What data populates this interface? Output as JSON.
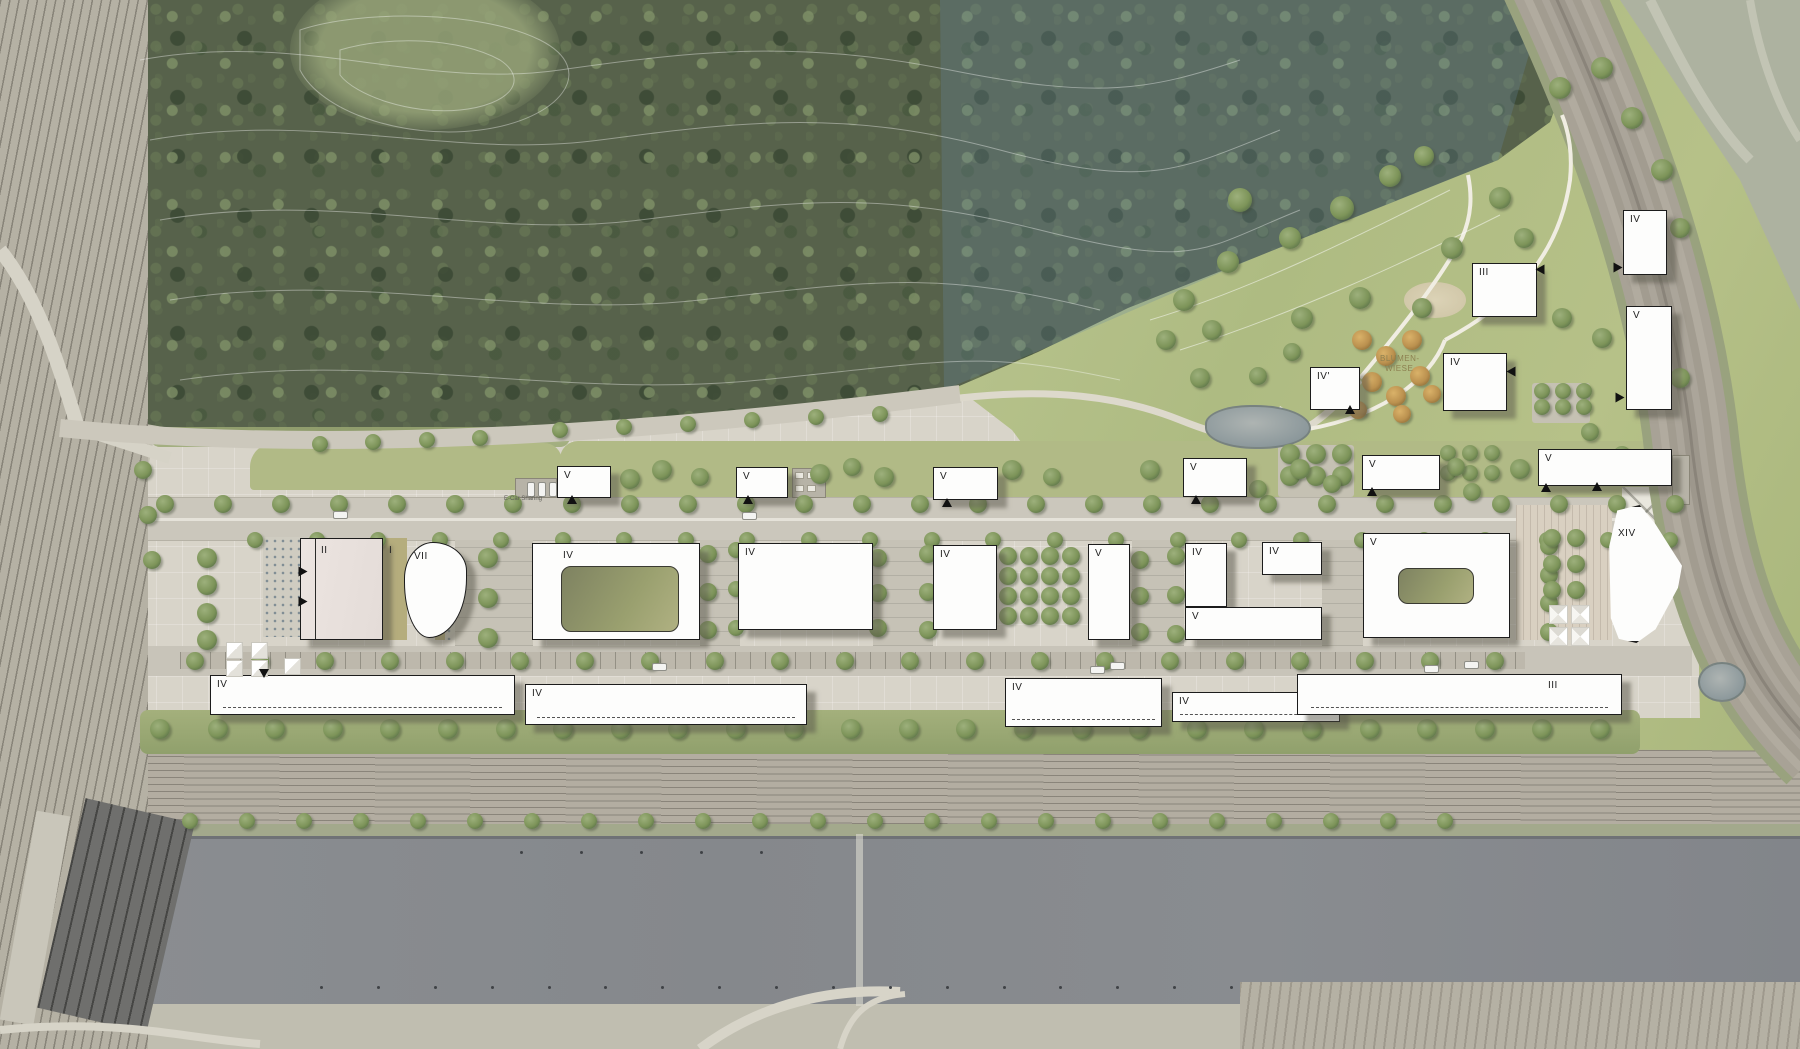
{
  "title": "Aerial master-plan site rendering",
  "texts": {
    "blumen_line1": "BLUMEN-",
    "blumen_line2": "WIESE",
    "ecar": "E-Car Sharing",
    "lawn_label": "I"
  },
  "colors": {
    "building_fill": "#fdfdfc",
    "building_outline": "#1c1c1c",
    "forest": "#57624b",
    "meadow": "#b2bd85",
    "water": "#888b90",
    "site_paving": "#d8d4c9",
    "street": "#cbc7bc",
    "orange_trees": "#c89a55"
  },
  "buildings": [
    {
      "l": "V",
      "x": 557,
      "y": 466,
      "w": 54,
      "h": 32
    },
    {
      "l": "V",
      "x": 736,
      "y": 467,
      "w": 52,
      "h": 31
    },
    {
      "l": "V",
      "x": 933,
      "y": 467,
      "w": 65,
      "h": 33
    },
    {
      "l": "V",
      "x": 1183,
      "y": 458,
      "w": 64,
      "h": 39
    },
    {
      "l": "V",
      "x": 1362,
      "y": 455,
      "w": 78,
      "h": 35
    },
    {
      "l": "V",
      "x": 1538,
      "y": 449,
      "w": 134,
      "h": 37
    },
    {
      "l": "IV",
      "x": 1623,
      "y": 210,
      "w": 44,
      "h": 65
    },
    {
      "l": "V",
      "x": 1626,
      "y": 306,
      "w": 46,
      "h": 104
    },
    {
      "l": "III",
      "x": 1472,
      "y": 263,
      "w": 65,
      "h": 54
    },
    {
      "l": "IV",
      "x": 1443,
      "y": 353,
      "w": 64,
      "h": 58
    },
    {
      "l": "IV'",
      "x": 1310,
      "y": 367,
      "w": 50,
      "h": 43
    },
    {
      "l": "V",
      "x": 1088,
      "y": 544,
      "w": 42,
      "h": 96
    },
    {
      "l": "IV",
      "x": 1185,
      "y": 543,
      "w": 42,
      "h": 64
    },
    {
      "l": "IV",
      "x": 1262,
      "y": 542,
      "w": 60,
      "h": 33
    },
    {
      "l": "V",
      "x": 1185,
      "y": 607,
      "w": 137,
      "h": 33
    },
    {
      "l": "V",
      "x": 1363,
      "y": 533,
      "w": 147,
      "h": 105,
      "court": [
        34,
        34,
        76,
        36
      ]
    },
    {
      "l": "XIV",
      "x": 1606,
      "y": 505,
      "w": 80,
      "h": 138,
      "shape": "xiv",
      "lx": 12,
      "ly": 24
    },
    {
      "l": "IV",
      "x": 532,
      "y": 543,
      "w": 168,
      "h": 97,
      "court": [
        28,
        22,
        118,
        66
      ],
      "lx": 30,
      "ly": 7
    },
    {
      "l": "IV",
      "x": 738,
      "y": 543,
      "w": 135,
      "h": 87
    },
    {
      "l": "IV",
      "x": 933,
      "y": 545,
      "w": 64,
      "h": 85
    },
    {
      "l": "II",
      "x": 300,
      "y": 538,
      "w": 83,
      "h": 102,
      "style": "pink",
      "lx": 20,
      "ly": 7
    },
    {
      "l": "VII",
      "x": 404,
      "y": 542,
      "w": 63,
      "h": 96,
      "shape": "blob",
      "lx": 9,
      "ly": 9
    },
    {
      "l": "IV",
      "x": 210,
      "y": 675,
      "w": 305,
      "h": 40,
      "dash": 1
    },
    {
      "l": "IV",
      "x": 525,
      "y": 684,
      "w": 282,
      "h": 41,
      "dash": 1
    },
    {
      "l": "IV",
      "x": 1005,
      "y": 678,
      "w": 157,
      "h": 49,
      "dash": 1
    },
    {
      "l": "IV",
      "x": 1172,
      "y": 692,
      "w": 168,
      "h": 30,
      "dash": 1
    },
    {
      "l": "III",
      "x": 1297,
      "y": 674,
      "w": 325,
      "h": 41,
      "dash": 1,
      "lx": 250,
      "ly": 6
    }
  ],
  "tree_rows": [
    [
      165,
      504,
      1675,
      504,
      27,
      9
    ],
    [
      255,
      540,
      1670,
      540,
      24,
      8
    ],
    [
      195,
      661,
      1495,
      661,
      21,
      9
    ],
    [
      160,
      729,
      1600,
      729,
      26,
      10
    ],
    [
      190,
      821,
      1445,
      821,
      23,
      8
    ],
    [
      207,
      558,
      207,
      640,
      4,
      10
    ],
    [
      143,
      470,
      152,
      560,
      3,
      9
    ],
    [
      878,
      558,
      878,
      628,
      3,
      9
    ],
    [
      928,
      554,
      928,
      630,
      3,
      9
    ],
    [
      1140,
      560,
      1140,
      632,
      3,
      9
    ],
    [
      1176,
      556,
      1176,
      634,
      3,
      9
    ],
    [
      708,
      554,
      708,
      630,
      3,
      9
    ],
    [
      736,
      550,
      736,
      628,
      3,
      8
    ],
    [
      488,
      558,
      488,
      638,
      3,
      10
    ],
    [
      1549,
      546,
      1549,
      632,
      4,
      9
    ],
    [
      320,
      444,
      480,
      438,
      4,
      8
    ],
    [
      560,
      430,
      880,
      414,
      6,
      8
    ]
  ],
  "tree_grids": [
    [
      1008,
      556,
      4,
      4,
      21,
      20,
      9
    ],
    [
      1290,
      454,
      3,
      2,
      26,
      22,
      10
    ],
    [
      1542,
      391,
      3,
      2,
      21,
      16,
      8
    ],
    [
      1448,
      453,
      3,
      2,
      22,
      20,
      8
    ],
    [
      1552,
      538,
      2,
      3,
      24,
      26,
      9
    ]
  ],
  "trees": [
    [
      630,
      479,
      10
    ],
    [
      662,
      470,
      10
    ],
    [
      700,
      477,
      9
    ],
    [
      820,
      474,
      10
    ],
    [
      852,
      467,
      9
    ],
    [
      884,
      477,
      10
    ],
    [
      1012,
      470,
      10
    ],
    [
      1052,
      477,
      9
    ],
    [
      1150,
      470,
      10
    ],
    [
      1258,
      489,
      9
    ],
    [
      1300,
      469,
      10
    ],
    [
      1332,
      484,
      9
    ],
    [
      1456,
      467,
      9
    ],
    [
      1472,
      492,
      9
    ],
    [
      1520,
      469,
      10
    ],
    [
      578,
      602,
      8
    ],
    [
      602,
      588,
      8
    ],
    [
      1458,
      612,
      9
    ],
    [
      1240,
      200,
      12
    ],
    [
      1290,
      238,
      11
    ],
    [
      1342,
      208,
      12
    ],
    [
      1390,
      176,
      11
    ],
    [
      1424,
      156,
      10
    ],
    [
      1302,
      318,
      11
    ],
    [
      1360,
      298,
      11
    ],
    [
      1422,
      308,
      10
    ],
    [
      1452,
      248,
      11
    ],
    [
      1500,
      198,
      11
    ],
    [
      1524,
      238,
      10
    ],
    [
      1560,
      88,
      11
    ],
    [
      1602,
      68,
      11
    ],
    [
      1632,
      118,
      11
    ],
    [
      1662,
      170,
      11
    ],
    [
      1680,
      228,
      10
    ],
    [
      1228,
      262,
      11
    ],
    [
      1184,
      300,
      11
    ],
    [
      1212,
      330,
      10
    ],
    [
      1562,
      318,
      10
    ],
    [
      1602,
      338,
      10
    ],
    [
      1644,
      350,
      10
    ],
    [
      1680,
      378,
      10
    ],
    [
      1590,
      432,
      9
    ],
    [
      1622,
      455,
      9
    ],
    [
      1200,
      378,
      10
    ],
    [
      1166,
      340,
      10
    ],
    [
      1258,
      376,
      9
    ],
    [
      1292,
      352,
      9
    ]
  ],
  "orange_trees": [
    [
      1362,
      340,
      10
    ],
    [
      1386,
      356,
      10
    ],
    [
      1412,
      340,
      10
    ],
    [
      1372,
      382,
      10
    ],
    [
      1396,
      396,
      10
    ],
    [
      1420,
      376,
      10
    ],
    [
      1358,
      410,
      9
    ],
    [
      1402,
      414,
      9
    ],
    [
      1432,
      394,
      9
    ]
  ],
  "arrows": [
    [
      303,
      572,
      90
    ],
    [
      303,
      602,
      90
    ],
    [
      572,
      500,
      0
    ],
    [
      748,
      500,
      0
    ],
    [
      947,
      503,
      0
    ],
    [
      1196,
      500,
      0
    ],
    [
      1372,
      492,
      0
    ],
    [
      1546,
      488,
      0
    ],
    [
      1597,
      487,
      0
    ],
    [
      264,
      674,
      180
    ],
    [
      1350,
      410,
      0
    ],
    [
      1540,
      270,
      -90
    ],
    [
      1511,
      372,
      -90
    ],
    [
      1618,
      268,
      90
    ],
    [
      1620,
      398,
      90
    ]
  ],
  "cars": [
    [
      333,
      511,
      0
    ],
    [
      742,
      512,
      0
    ],
    [
      652,
      663,
      0
    ],
    [
      1110,
      662,
      0
    ],
    [
      1424,
      665,
      0
    ],
    [
      1464,
      661,
      0
    ],
    [
      527,
      482,
      1
    ],
    [
      538,
      482,
      1
    ],
    [
      549,
      482,
      1
    ],
    [
      1090,
      666,
      0
    ]
  ],
  "canopies": [
    [
      226,
      642
    ],
    [
      251,
      642
    ],
    [
      226,
      660
    ],
    [
      251,
      660
    ],
    [
      284,
      658
    ]
  ],
  "pyramids": [
    [
      1549,
      605
    ],
    [
      1571,
      605
    ],
    [
      1549,
      627
    ],
    [
      1571,
      627
    ]
  ],
  "ponds": [
    {
      "x": 1205,
      "y": 405,
      "w": 106,
      "h": 44,
      "r": "45% 55% 50% 50%"
    },
    {
      "x": 1698,
      "y": 662,
      "w": 48,
      "h": 40,
      "r": "50%"
    }
  ],
  "pads": [
    [
      1278,
      445,
      76,
      52
    ],
    [
      1532,
      383,
      58,
      40
    ]
  ],
  "decks": [
    [
      1516,
      505,
      96,
      135,
      "deck"
    ],
    [
      1622,
      487,
      50,
      48,
      "xdeck"
    ]
  ],
  "services": [
    [
      792,
      468,
      34,
      30
    ],
    [
      1672,
      455,
      18,
      50
    ],
    [
      515,
      478,
      42,
      20
    ]
  ],
  "dot_plazas": [
    [
      263,
      537,
      38,
      100
    ],
    [
      445,
      555,
      40,
      85
    ]
  ],
  "lawns": [
    [
      383,
      538,
      24,
      102
    ],
    [
      435,
      595,
      35,
      45
    ]
  ],
  "cross_streets": [
    [
      455,
      540,
      78,
      106
    ],
    [
      700,
      540,
      40,
      106
    ],
    [
      873,
      540,
      60,
      106
    ],
    [
      1132,
      540,
      52,
      106
    ],
    [
      1322,
      540,
      41,
      106
    ]
  ],
  "canal_posts": {
    "row1": {
      "x1": 320,
      "x2": 1230,
      "y": 986,
      "n": 17
    },
    "row2": {
      "x1": 520,
      "x2": 760,
      "y": 851,
      "n": 5
    }
  }
}
